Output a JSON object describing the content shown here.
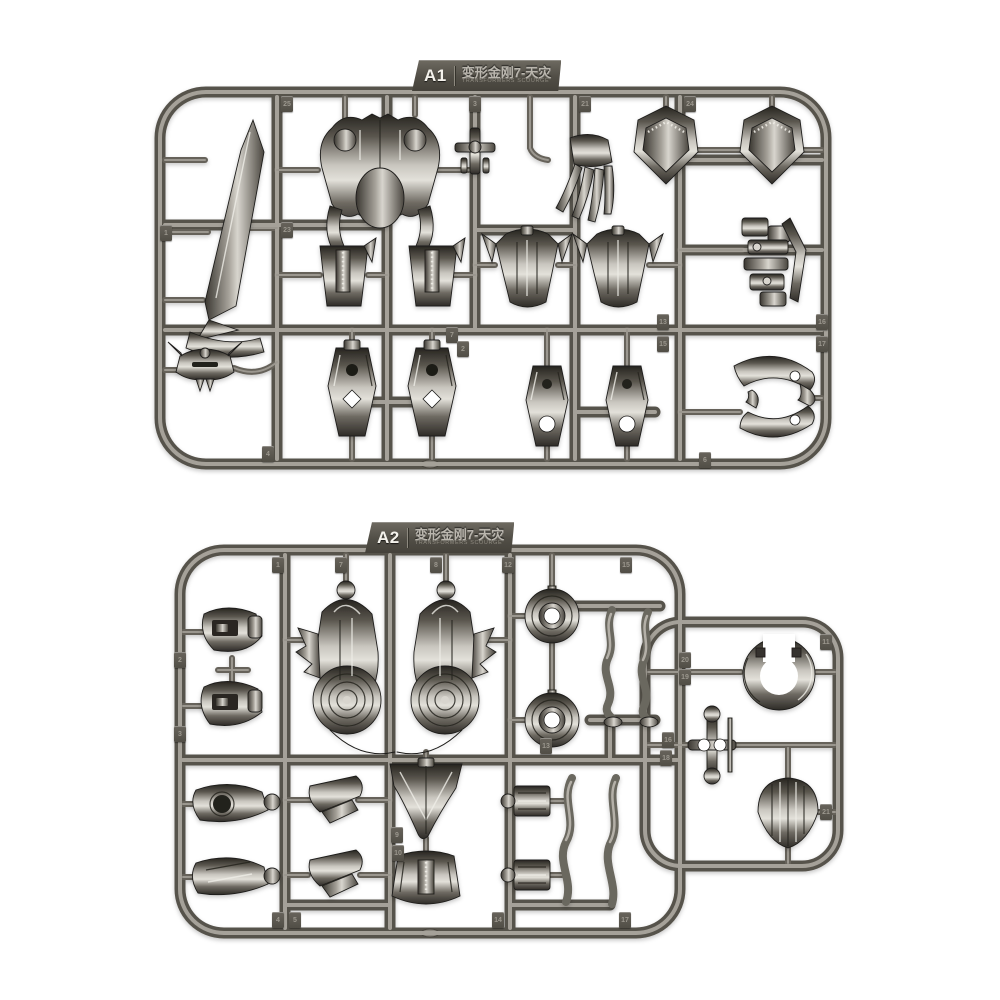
{
  "photo": {
    "description": "Two injection-molded model kit sprues (runners) of gunmetal silver plastic with robot figure parts, photographed on a white background",
    "background_color": "#ffffff",
    "plastic_base_color": "#57534b",
    "plastic_highlight_color": "#a5a199",
    "part_metal_light": "#d8d5ce",
    "part_metal_dark": "#26241f",
    "tag_plate_color": "#514e46",
    "tag_text_color": "#f4f2ec"
  },
  "sprues": [
    {
      "id": "A1",
      "tag": {
        "code": "A1",
        "title": "变形金刚7-天灾",
        "subtitle": "TRANSFORMERS SCOURGE"
      },
      "parts": [
        "sword blade",
        "torso chest armor",
        "small joint connector",
        "claw hand",
        "shoulder armor (left)",
        "shoulder armor (right)",
        "folded mechanism cluster",
        "forearm bucket (left)",
        "forearm bucket (right)",
        "winged shin (left)",
        "winged shin (right)",
        "horned face mask",
        "thigh with cross slot (left)",
        "thigh with cross slot (right)",
        "lower leg (left)",
        "lower leg (right)",
        "curved armor ring segments"
      ],
      "number_tags": [
        {
          "label": "1",
          "x": 160,
          "y": 225
        },
        {
          "label": "25",
          "x": 281,
          "y": 96
        },
        {
          "label": "23",
          "x": 281,
          "y": 222
        },
        {
          "label": "3",
          "x": 469,
          "y": 96
        },
        {
          "label": "21",
          "x": 579,
          "y": 96
        },
        {
          "label": "24",
          "x": 684,
          "y": 96
        },
        {
          "label": "7",
          "x": 446,
          "y": 327
        },
        {
          "label": "2",
          "x": 457,
          "y": 341
        },
        {
          "label": "13",
          "x": 657,
          "y": 314
        },
        {
          "label": "15",
          "x": 657,
          "y": 336
        },
        {
          "label": "16",
          "x": 816,
          "y": 314
        },
        {
          "label": "17",
          "x": 816,
          "y": 336
        },
        {
          "label": "4",
          "x": 262,
          "y": 446
        },
        {
          "label": "6",
          "x": 699,
          "y": 452
        }
      ]
    },
    {
      "id": "A2",
      "tag": {
        "code": "A2",
        "title": "变形金刚7-天灾",
        "subtitle": "TRANSFORMERS SCOURGE"
      },
      "parts": [
        "rounded head shell (upper)",
        "rounded head shell (lower)",
        "shoulder wheel assembly (left)",
        "shoulder wheel assembly (right)",
        "wheel hub (upper)",
        "wheel hub (lower)",
        "zigzag arm linkage pair",
        "collar clamp",
        "double ball joint cross",
        "striped dome shoulder",
        "forearm pod (upper)",
        "forearm pod (lower)",
        "fin foot (upper)",
        "fin foot (lower)",
        "V-shaped chest plate",
        "waist block",
        "joint block (upper)",
        "joint block (lower)",
        "zigzag leg linkage pair"
      ],
      "number_tags": [
        {
          "label": "1",
          "x": 272,
          "y": 557
        },
        {
          "label": "7",
          "x": 335,
          "y": 557
        },
        {
          "label": "8",
          "x": 430,
          "y": 557
        },
        {
          "label": "12",
          "x": 502,
          "y": 557
        },
        {
          "label": "15",
          "x": 620,
          "y": 557
        },
        {
          "label": "11",
          "x": 820,
          "y": 634
        },
        {
          "label": "20",
          "x": 679,
          "y": 652
        },
        {
          "label": "19",
          "x": 679,
          "y": 669
        },
        {
          "label": "16",
          "x": 662,
          "y": 732
        },
        {
          "label": "18",
          "x": 660,
          "y": 750
        },
        {
          "label": "2",
          "x": 174,
          "y": 652
        },
        {
          "label": "3",
          "x": 174,
          "y": 726
        },
        {
          "label": "9",
          "x": 391,
          "y": 827
        },
        {
          "label": "10",
          "x": 392,
          "y": 845
        },
        {
          "label": "4",
          "x": 272,
          "y": 912
        },
        {
          "label": "5",
          "x": 289,
          "y": 912
        },
        {
          "label": "14",
          "x": 492,
          "y": 912
        },
        {
          "label": "17",
          "x": 619,
          "y": 912
        },
        {
          "label": "21",
          "x": 820,
          "y": 804
        },
        {
          "label": "13",
          "x": 540,
          "y": 738
        }
      ]
    }
  ]
}
